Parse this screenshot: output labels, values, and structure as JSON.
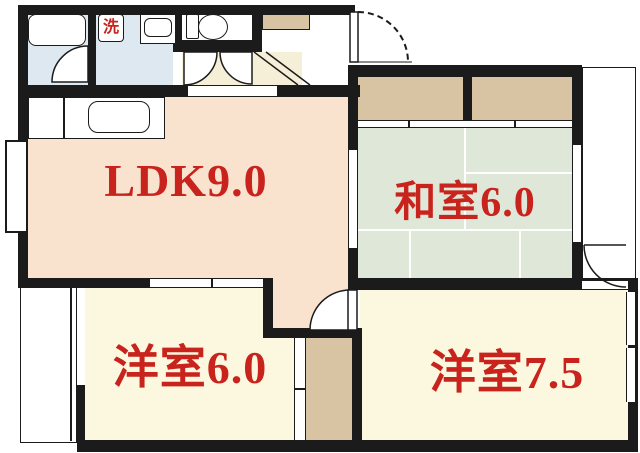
{
  "plan_title": "2LDK floor plan",
  "rooms": {
    "ldk": {
      "label": "LDK9.0"
    },
    "japanese_room": {
      "label": "和室6.0"
    },
    "western_room_1": {
      "label": "洋室6.0"
    },
    "western_room_2": {
      "label": "洋室7.5"
    }
  },
  "fixtures": {
    "washing_machine": {
      "label": "洗"
    }
  },
  "colors": {
    "wall": "#1b1b1b",
    "line": "#1b1b1b",
    "ldk-floor": "#f9e2ce",
    "western-floor": "#fcf8df",
    "tatami": "#dfe8d8",
    "closet": "#d8c4a3",
    "wet-floor": "#dde8f1",
    "hall-floor": "#f5efd8",
    "label-red": "#c8231c"
  }
}
